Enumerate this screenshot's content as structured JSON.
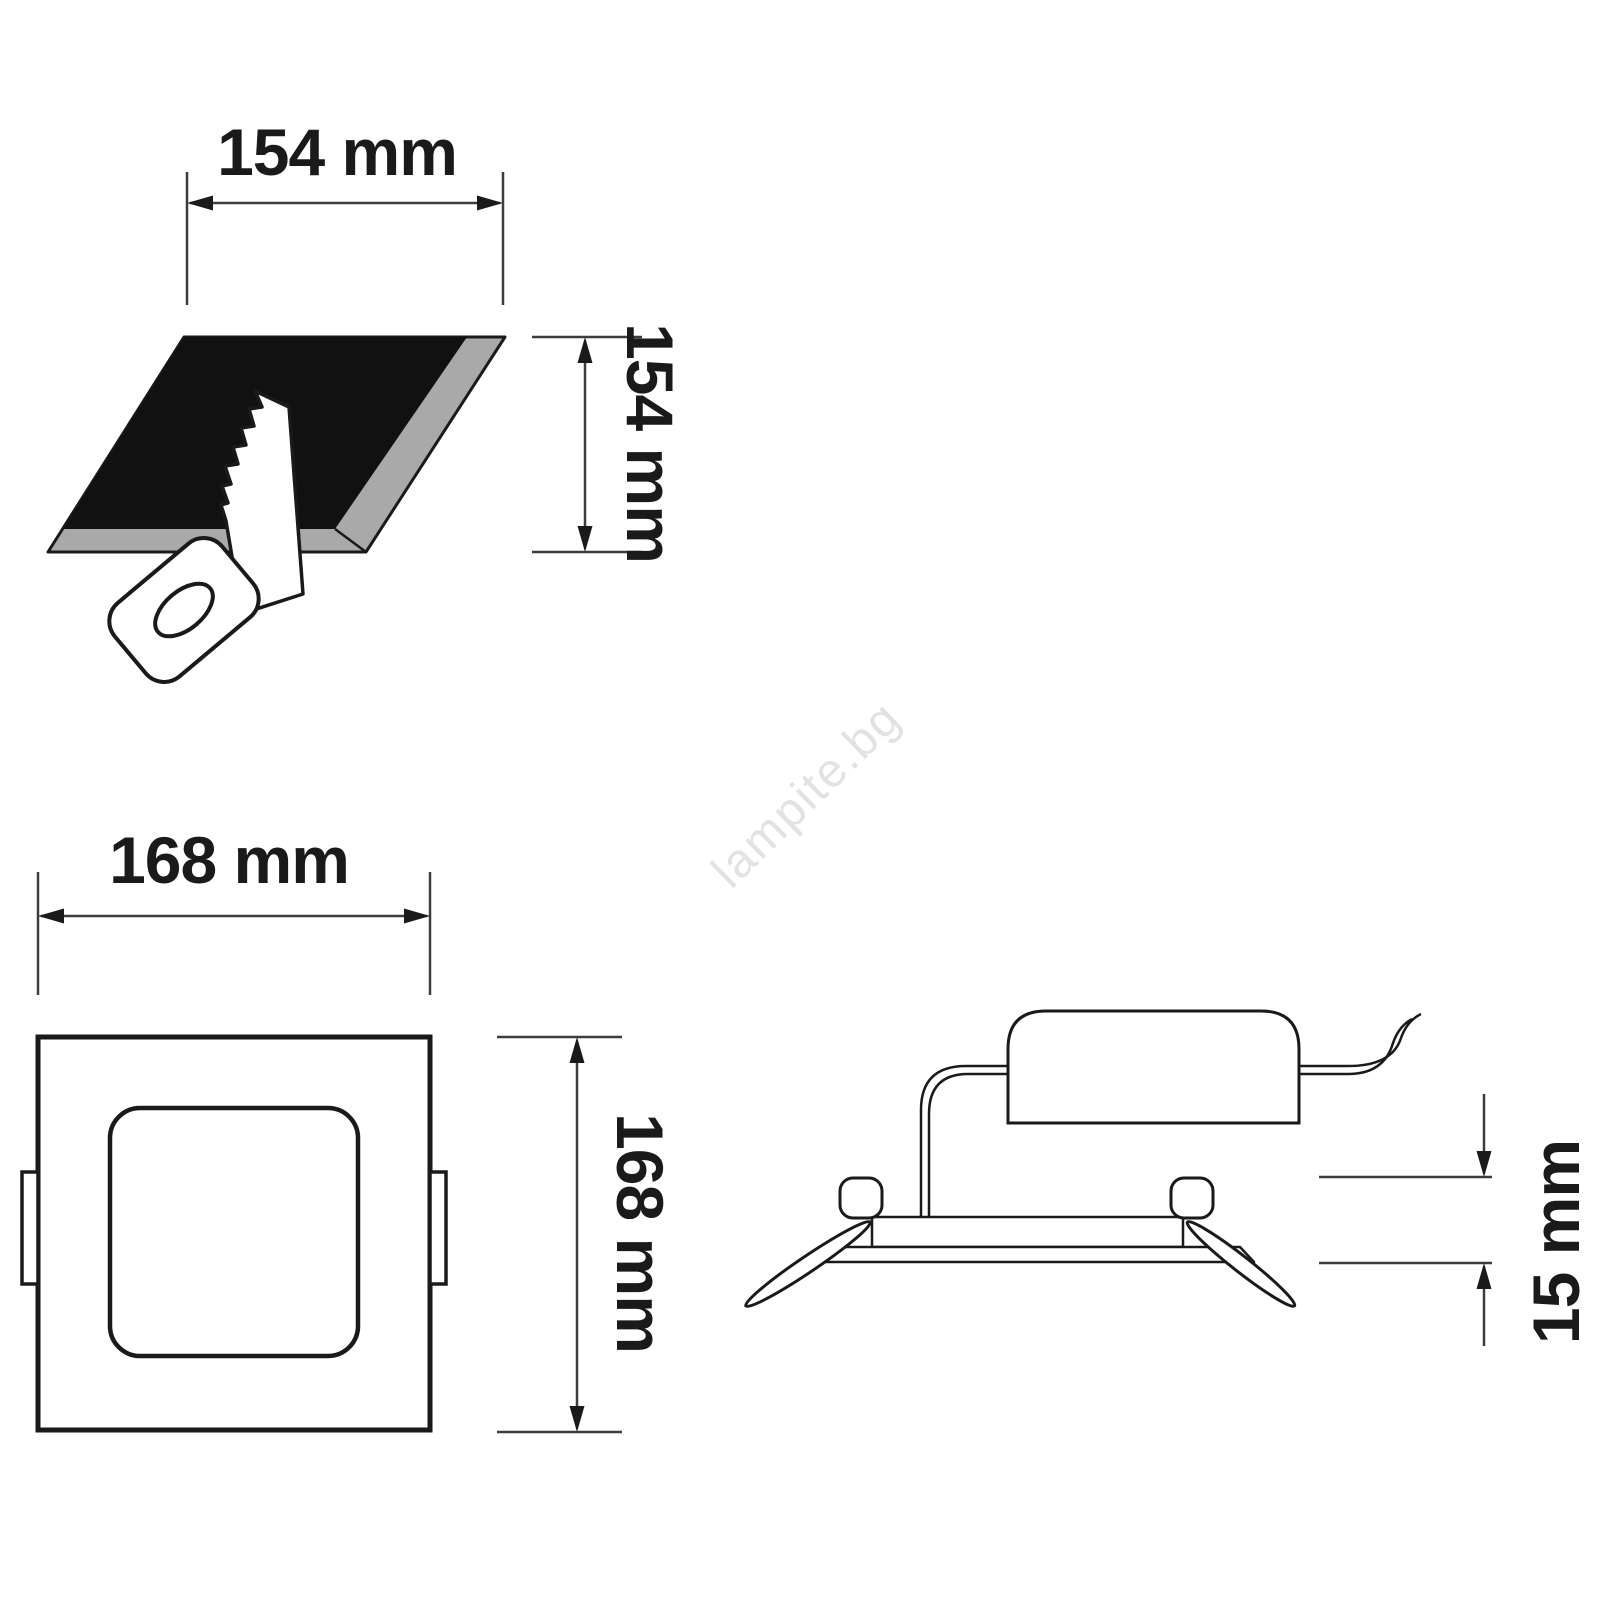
{
  "diagram": {
    "type": "product-dimension-drawing",
    "product": "recessed square LED panel light",
    "views": {
      "cutout": {
        "name": "ceiling-cutout-view",
        "width_label": "154 mm",
        "height_label": "154 mm"
      },
      "front": {
        "name": "panel-front-view",
        "width_label": "168 mm",
        "height_label": "168 mm"
      },
      "side": {
        "name": "panel-side-view",
        "depth_label": "15 mm"
      }
    },
    "watermark": "lampite.bg",
    "colors": {
      "background": "#ffffff",
      "line": "#1a1a1a",
      "dimension_line": "#3d3d3d",
      "bevel_gray": "#a9a9a9",
      "hole_black": "#111111",
      "watermark_gray": "#e2e2e2"
    }
  }
}
